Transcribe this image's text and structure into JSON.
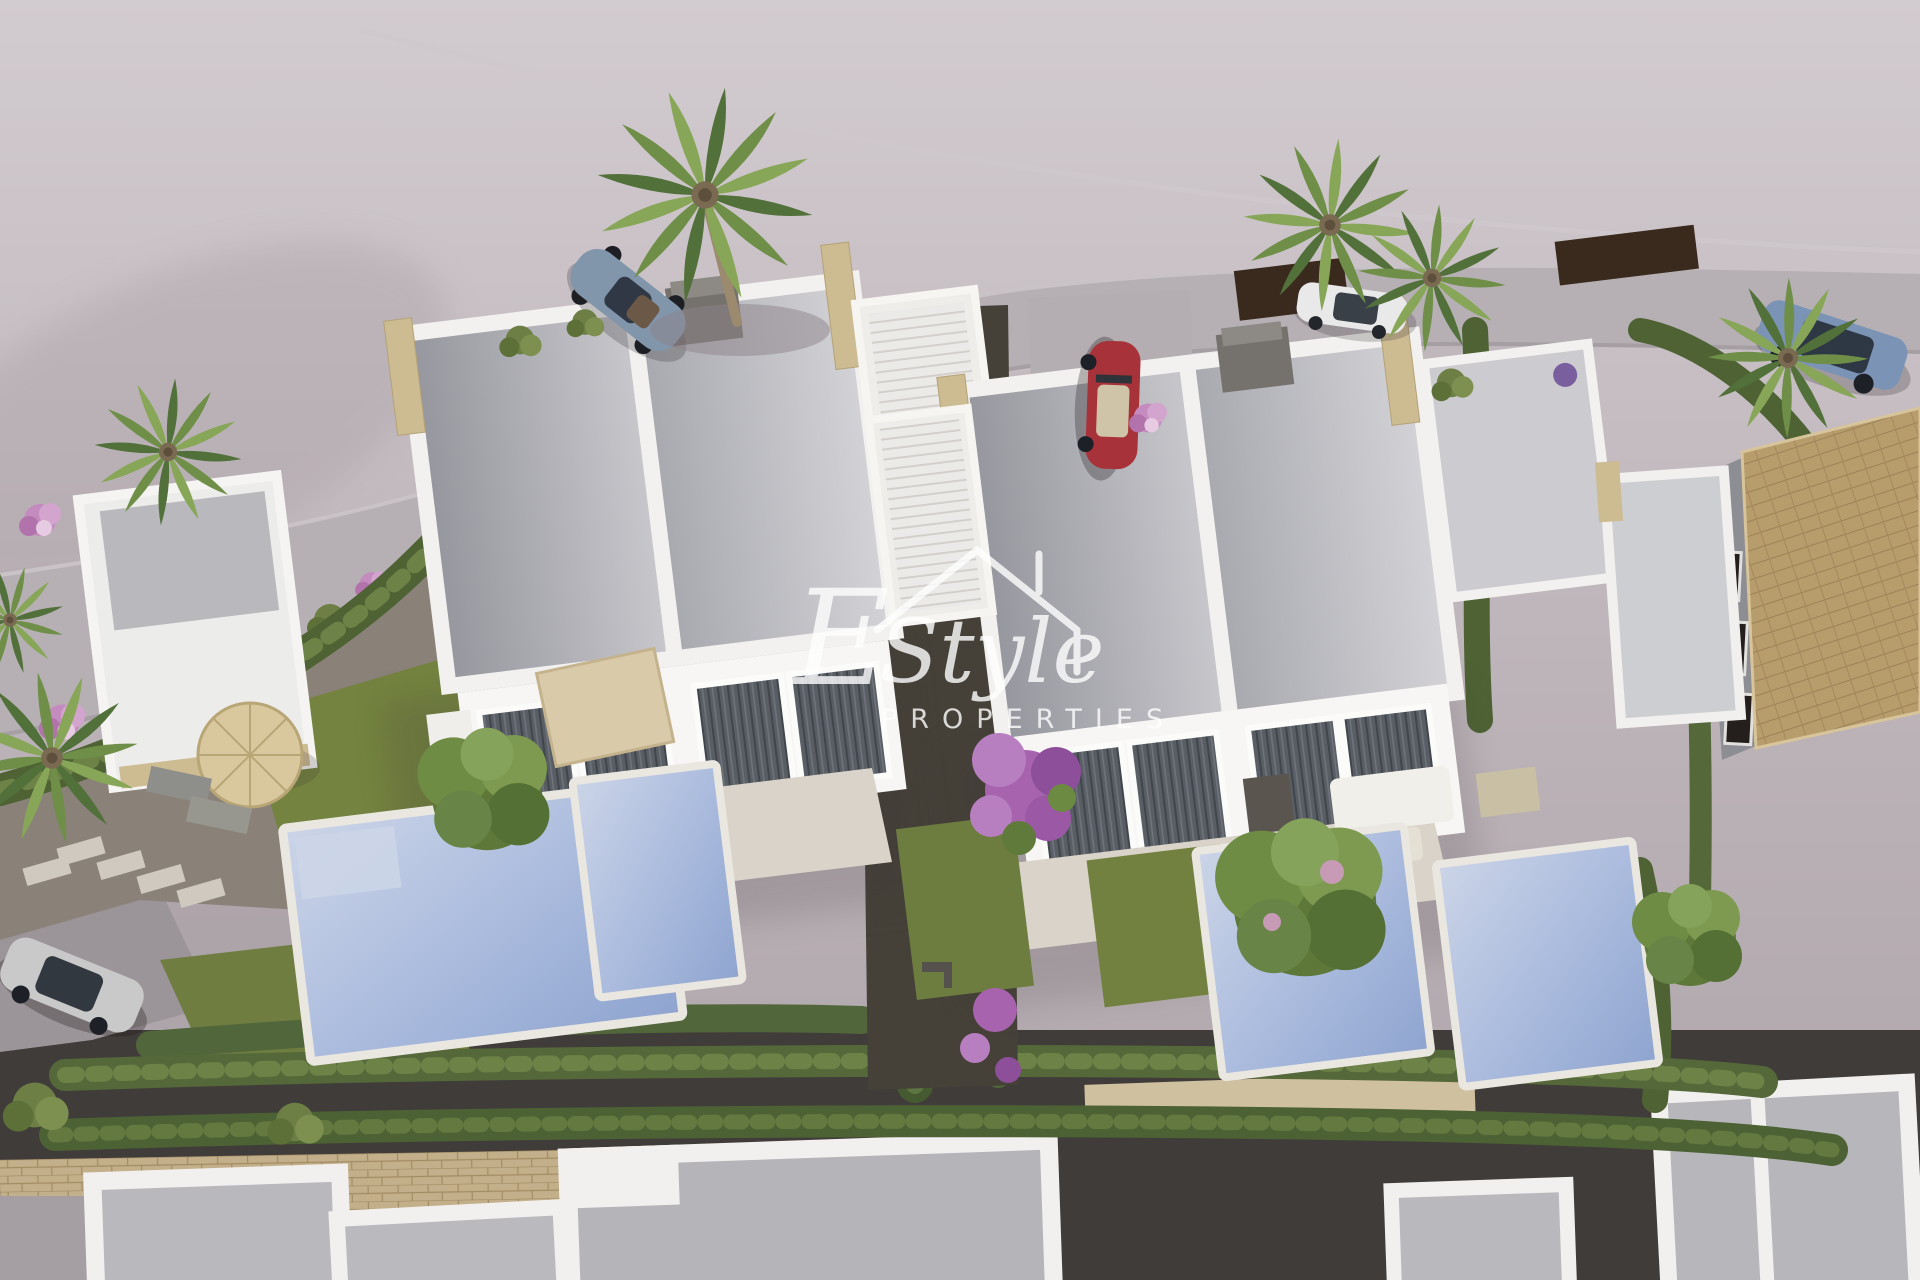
{
  "meta": {
    "type": "3d-aerial-architectural-render",
    "subject": "new-build development of modern white villas with private pools and gardens"
  },
  "watermark": {
    "initial": "E",
    "script": "Style",
    "subtitle": "PROPERTIES",
    "emblem": "house-roof-outline-with-chimney"
  },
  "palette": {
    "terrain": "#c4bcc1",
    "road": "#b6b0b4",
    "villa_wall": "#f6f5f3",
    "roof_panel": "#b3b3b9",
    "stone_pillar": "#cdbb92",
    "hedge_green": "#55683a",
    "lawn_green": "#71803f",
    "pool_water": "#a7b9da",
    "dark_gravel": "#413d3a",
    "garden_gravel": "#8a8279",
    "terrace_deck": "#d9d3c9",
    "tiled_roof": "#b79c6c",
    "flower_pink": "#c487bd",
    "bougainvillea_purple": "#a763ae",
    "car_red": "#a8323a",
    "car_suv_blue": "#7b93b5",
    "car_sports_blue": "#8195ab",
    "car_white": "#e9e9ea",
    "car_silver": "#c9c9c9"
  },
  "objects": {
    "villas": 2,
    "pools": 4,
    "palm_trees": 6,
    "cars": [
      "sports-car-on-road",
      "white-car-top",
      "blue-suv-right",
      "red-convertible-driveway",
      "silver-hatchback-bottom-left"
    ]
  }
}
